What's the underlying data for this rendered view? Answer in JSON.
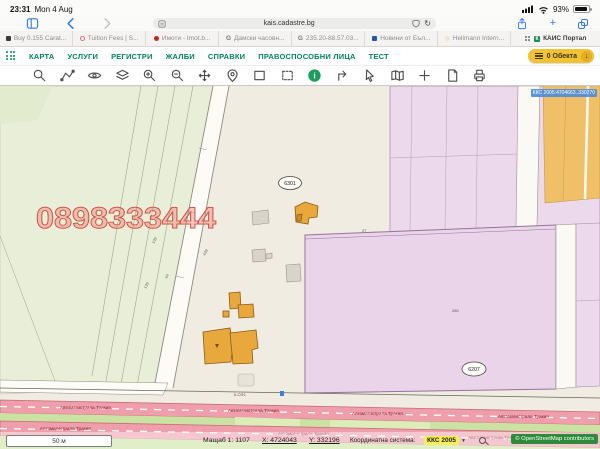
{
  "status_bar": {
    "time": "23:31",
    "date": "Mon 4 Aug",
    "battery_percent": "93%"
  },
  "browser": {
    "url": "kais.cadastre.bg",
    "reload_glyph": "↻",
    "new_tab_glyph": "+"
  },
  "tab_bar": {
    "tabs": [
      {
        "label": "Buy 0.155 Carat..."
      },
      {
        "label": "Tuition Fees | S..."
      },
      {
        "label": "Имоти - Imot.b..."
      },
      {
        "label": "Дамски часовн...",
        "badge": "G"
      },
      {
        "label": "235.20-88.57.03...",
        "badge": "G"
      },
      {
        "label": "Новини от Бъл..."
      },
      {
        "label": "Hellmann Intern..."
      },
      {
        "label": "КАИС Портал",
        "badge": "К"
      }
    ]
  },
  "nav": {
    "items": [
      "КАРТА",
      "УСЛУГИ",
      "РЕГИСТРИ",
      "ЖАЛБИ",
      "СПРАВКИ",
      "ПРАВОСПОСОБНИ ЛИЦА",
      "ТЕСТ"
    ],
    "objects_button_label": "0 Обекта",
    "download_glyph": "↓"
  },
  "map_tools": {
    "info_glyph": "i"
  },
  "map": {
    "watermark": "0898333444",
    "district_labels": {
      "a": "6301",
      "b": "6207"
    },
    "parcel_numbers": [
      "139",
      "44",
      "139",
      "439",
      "27",
      "280"
    ],
    "road_label": "6-ОФ1",
    "highway_name": "Автомагистрала Тракия",
    "coord_tooltip": "ККС 2005:4704663..330270"
  },
  "footer": {
    "scale_bar_label": "50 м",
    "scale_text": "Мащаб 1: 1107",
    "x_label": "X: 4724043",
    "y_label": "Y: 332196",
    "coord_system_label": "Координатна система:",
    "coord_system_value": "ККС 2005",
    "caret_glyph": "▼",
    "osm_attribution": "© OpenStreetMap contributors"
  }
}
